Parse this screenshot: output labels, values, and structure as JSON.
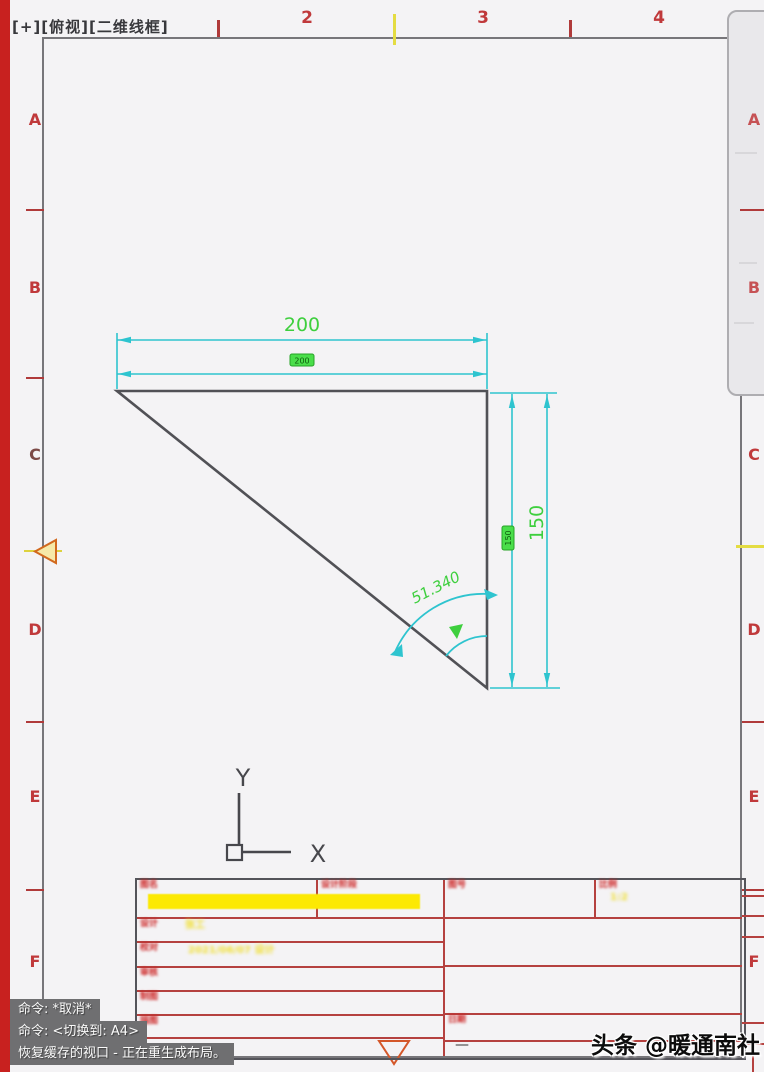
{
  "viewport_label": "[+][俯视][二维线框]",
  "zones": {
    "top": [
      "2",
      "3",
      "4"
    ],
    "left": [
      "A",
      "B",
      "C",
      "D",
      "E",
      "F"
    ],
    "right_panel": [
      "A",
      "B"
    ],
    "right": [
      "C",
      "D",
      "E",
      "F"
    ]
  },
  "dimensions": {
    "top": "200",
    "top_small": "200",
    "right": "150",
    "right_small": "150",
    "angle": "51.340"
  },
  "ucs": {
    "x": "X",
    "y": "Y"
  },
  "title_block": {
    "row1_label": "图名",
    "stage_label": "设计阶段",
    "no_label": "图号",
    "scale_label": "比例",
    "scale_value": "1:2",
    "row2_label": "设计",
    "row2_value": "张工",
    "row3_label": "校对",
    "row3_value": "2021/06/07 设计",
    "row4_label": "审核",
    "row5_label": "制图",
    "row6_label": "描图",
    "bottom_label": "日期",
    "dash": "—"
  },
  "command": {
    "line1": "命令: *取消*",
    "line2": "命令: <切换到: A4>",
    "line3": "恢复缓存的视口 - 正在重生成布局。"
  },
  "watermark": "头条 @暖通南社",
  "colors": {
    "dim_cyan": "#2ec4cf",
    "dim_text_green": "#3ecf3e",
    "entity_gray": "#515156",
    "frame_red": "#b5413f",
    "zone_red": "#c0393b",
    "left_bar_red": "#c8211f",
    "highlight_yellow": "#fce903",
    "command_bg": "#6f6f71"
  }
}
